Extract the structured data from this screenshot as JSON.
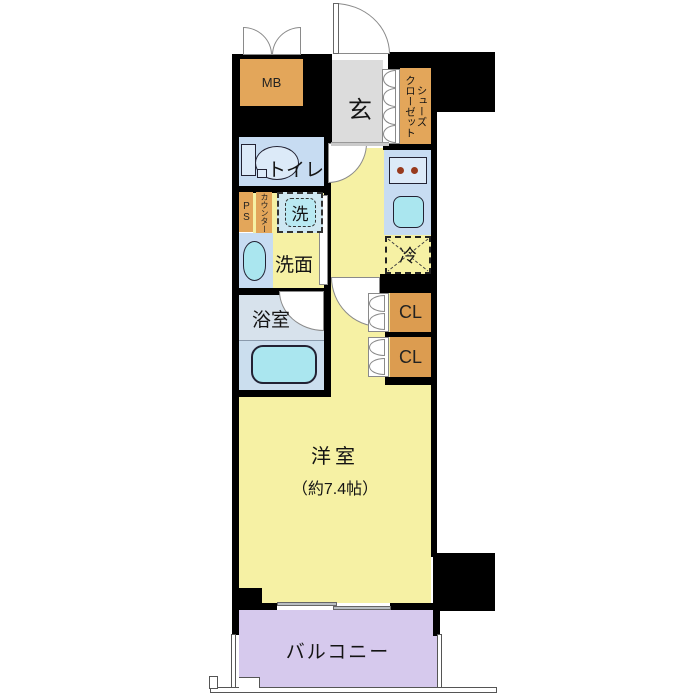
{
  "labels": {
    "mb": "MB",
    "entrance": "玄",
    "shoes_col_left": "クローゼット",
    "shoes_col_right": "シューズ",
    "toilet": "トイレ",
    "ps": "PS",
    "counter": "カウンター",
    "washer": "洗",
    "washroom": "洗面",
    "bathroom": "浴室",
    "fridge": "冷",
    "closet_upper": "CL",
    "closet_lower": "CL",
    "main_room_line1": "洋室",
    "main_room_line2": "（約7.4帖）",
    "balcony": "バルコニー"
  },
  "colors": {
    "wall": "#000000",
    "floor_yellow": "#F6F1A4",
    "floor_gray": "#DCDCDC",
    "floor_blue": "#C7DCF2",
    "bath_floor": "#D7E2EC",
    "tub_area": "#CBDEEE",
    "fixture_cyan": "#AAE6EF",
    "fixture_light": "#DCEAF8",
    "cabinet_orange": "#E3A65A",
    "closet_orange": "#DC9C50",
    "balcony_purple": "#D6C9ED",
    "burner": "#983A1D",
    "window_gray": "#B9BEC2",
    "arc": "#8A8A8A",
    "rail": "#555555"
  }
}
